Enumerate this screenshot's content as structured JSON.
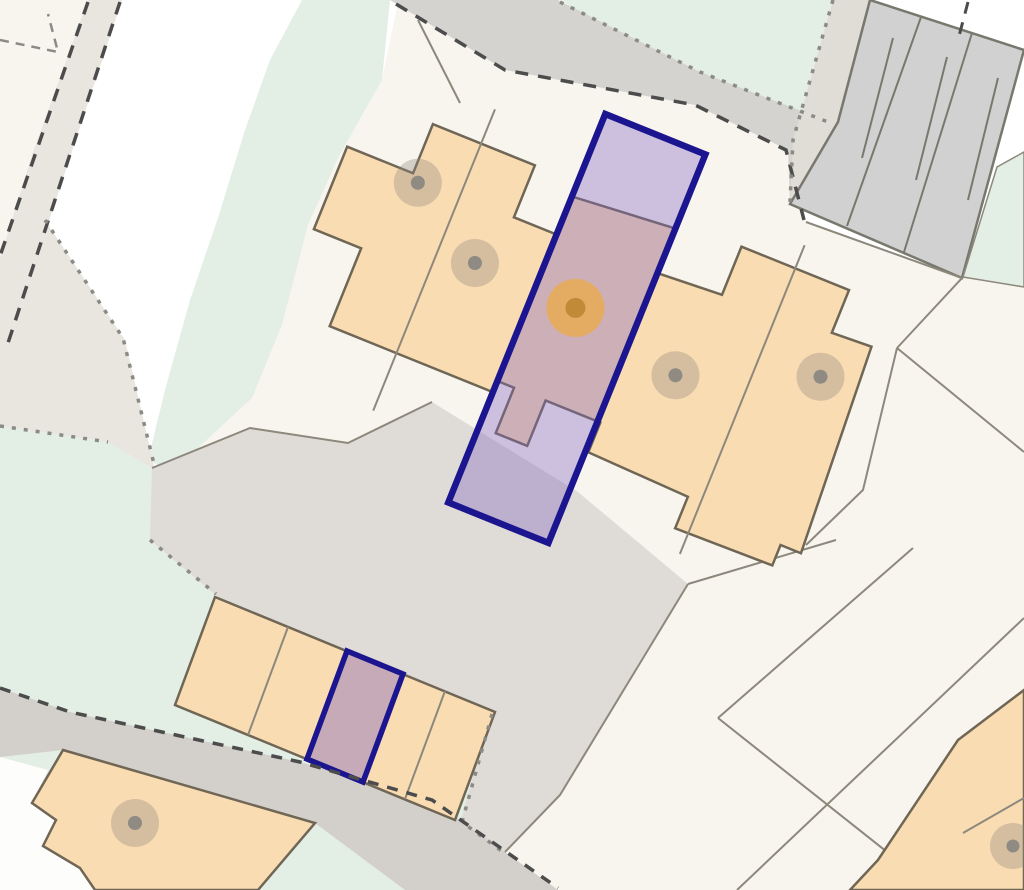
{
  "map": {
    "title": "property-plot-map",
    "canvas": {
      "width": 1024,
      "height": 890,
      "background": "#ffffff"
    },
    "palette": {
      "bg": "#ffffff",
      "parcelLight": "#f8f5ef",
      "verge": "#e9e5df",
      "green": "#e3eee5",
      "roadTop": "#d4d3d0",
      "bandCenter": "#dfdbd6",
      "roadBottom": "#d3d0cb",
      "margin": "#e0ddd6",
      "block": "#d1d1d1",
      "blockLine": "#78786f",
      "orange": "#f9dcb2",
      "outline": "#6f6655",
      "thin": "#8d887c",
      "dashDark": "#4c4c4c",
      "dot": "#8b8b86",
      "navy": "#1c1590",
      "purple": "rgba(128,100,190,0.36)",
      "purpleStall": "rgba(128,100,190,0.42)",
      "white": "#fdfdfb",
      "grayMarkOuter": "rgba(143,134,122,0.35)",
      "grayMarkInner": "#8f8a82",
      "orangeMarkOuter": "rgba(232,170,85,0.85)",
      "orangeMarkInner": "#c08a38"
    },
    "legend": {
      "highlight_plot_border": "#1c1590",
      "highlight_plot_fill": "purple translucent",
      "building_fill": "#f9dcb2",
      "green_space_fill": "#e3eee5",
      "road_fill": "#d4d3d0",
      "property_marker": "orange dot",
      "building_marker": "gray dot"
    },
    "features": [
      {
        "name": "estate-parcels",
        "kind": "polygon",
        "fill": "parcelLight",
        "points": "398,2 505,70 695,105 788,150 806,222 962,278 1024,205 1024,890 380,890 152,468 172,472 252,398 282,325 308,225 338,158 382,80"
      },
      {
        "name": "parcel-top-left",
        "kind": "polygon",
        "fill": "parcelLight",
        "points": "0,0 88,0 32,155 0,258"
      },
      {
        "name": "road-verge-left",
        "kind": "polygon",
        "fill": "verge",
        "points": "88,0 122,0 8,345 0,345 0,258 32,155"
      },
      {
        "name": "green-space-left",
        "kind": "polygon",
        "fill": "green",
        "points": "302,0 390,0 382,80 338,158 308,225 282,325 252,398 172,472 148,460 165,390 190,300 218,218 245,130 270,60"
      },
      {
        "name": "green-space-bottom",
        "kind": "polygon",
        "fill": "green",
        "points": "0,426 108,442 155,470 150,540 225,592 490,712 460,824 505,855 432,890 0,890"
      },
      {
        "name": "green-space-top-right",
        "kind": "polygon",
        "fill": "green",
        "points": "562,0 833,0 793,140 788,150 695,105"
      },
      {
        "name": "verge-wedge-center-left",
        "kind": "polygon",
        "fill": "verge",
        "points": "0,300 45,220 125,340 155,470 108,442 0,426"
      },
      {
        "name": "road-top",
        "kind": "polygon",
        "fill": "roadTop",
        "points": "390,0 505,70 695,105 788,150 790,204 830,122 700,72 558,0"
      },
      {
        "name": "garage-court-margin",
        "kind": "polygon",
        "fill": "margin",
        "points": "833,0 870,0 838,122 790,204 793,140"
      },
      {
        "name": "driveway-band-center",
        "kind": "polygon",
        "fill": "bandCenter",
        "points": "152,468 250,428 348,443 432,402 578,492 688,584 560,795 505,852 460,824 490,712 218,597 150,540"
      },
      {
        "name": "road-bottom",
        "kind": "polygon",
        "fill": "roadBottom",
        "points": "0,688 70,712 300,762 432,800 558,890 405,890 315,823 63,750 0,757"
      },
      {
        "name": "parcel-bottom-left-corner",
        "kind": "polygon",
        "fill": "white",
        "points": "0,757 48,770 32,803 56,820 43,846 80,868 95,890 0,890"
      },
      {
        "name": "building-bottom-left",
        "kind": "path",
        "fill": "orange",
        "stroke": "outline",
        "sw": 2.5,
        "d": "M63,750 L315,823 L258,890 L95,890 L80,868 L43,846 L56,820 L32,803 Z"
      },
      {
        "name": "building-marker-bottom-left-outer",
        "kind": "circle",
        "cx": 135,
        "cy": 823,
        "r": 24,
        "fill": "grayMarkOuter",
        "interactable": true
      },
      {
        "name": "building-marker-bottom-left-dot",
        "kind": "circle",
        "cx": 135,
        "cy": 823,
        "r": 7,
        "fill": "grayMarkInner"
      },
      {
        "name": "garage-block-top-right",
        "kind": "polygon",
        "fill": "block",
        "stroke": "blockLine",
        "sw": 2.5,
        "points": "870,0 1024,50 962,278 790,204 838,122"
      },
      {
        "name": "garage-block-divider-1",
        "kind": "line",
        "x1": 921,
        "y1": 17,
        "x2": 847,
        "y2": 226,
        "stroke": "blockLine",
        "sw": 2
      },
      {
        "name": "garage-block-divider-2",
        "kind": "line",
        "x1": 972,
        "y1": 33,
        "x2": 904,
        "y2": 252,
        "stroke": "blockLine",
        "sw": 2
      },
      {
        "name": "garage-block-stub-1",
        "kind": "line",
        "x1": 893,
        "y1": 38,
        "x2": 862,
        "y2": 158,
        "stroke": "blockLine",
        "sw": 2
      },
      {
        "name": "garage-block-stub-2",
        "kind": "line",
        "x1": 947,
        "y1": 57,
        "x2": 916,
        "y2": 180,
        "stroke": "blockLine",
        "sw": 2
      },
      {
        "name": "garage-block-stub-3",
        "kind": "line",
        "x1": 998,
        "y1": 78,
        "x2": 968,
        "y2": 200,
        "stroke": "blockLine",
        "sw": 2
      },
      {
        "name": "green-parcel-right-of-garages",
        "kind": "polygon",
        "fill": "green",
        "stroke": "thin",
        "sw": 1.5,
        "points": "997,167 1024,152 1024,287 963,277"
      },
      {
        "name": "boundary-below-garage-block",
        "kind": "polyline",
        "stroke": "thin",
        "sw": 2,
        "points": "806,222 962,278 897,348"
      },
      {
        "name": "boundary-right-1",
        "kind": "polyline",
        "stroke": "thin",
        "sw": 2,
        "points": "897,348 1024,452"
      },
      {
        "name": "boundary-right-2",
        "kind": "polyline",
        "stroke": "thin",
        "sw": 2,
        "points": "897,348 863,490 806,545"
      },
      {
        "name": "boundary-right-3",
        "kind": "polyline",
        "stroke": "thin",
        "sw": 2,
        "points": "836,540 688,584"
      },
      {
        "name": "boundary-right-4",
        "kind": "polyline",
        "stroke": "thin",
        "sw": 2,
        "points": "913,548 718,718"
      },
      {
        "name": "boundary-right-5",
        "kind": "polyline",
        "stroke": "thin",
        "sw": 2,
        "points": "1024,618 737,890"
      },
      {
        "name": "boundary-right-6",
        "kind": "polyline",
        "stroke": "thin",
        "sw": 2,
        "points": "718,718 935,890"
      },
      {
        "name": "driveway-edge-right",
        "kind": "polyline",
        "stroke": "thin",
        "sw": 2,
        "points": "688,584 560,795 505,852"
      },
      {
        "name": "driveway-edge-top",
        "kind": "polyline",
        "stroke": "thin",
        "sw": 2,
        "points": "152,468 250,428 348,443 432,402"
      },
      {
        "name": "parcel-line-top",
        "kind": "polyline",
        "stroke": "thin",
        "sw": 2,
        "points": "418,20 460,103"
      },
      {
        "name": "building-bottom-right",
        "kind": "path",
        "fill": "orange",
        "stroke": "outline",
        "sw": 2.5,
        "d": "M1024,690 L958,740 L878,860 L850,890 L1024,890 Z"
      },
      {
        "name": "building-bottom-right-divider",
        "kind": "line",
        "x1": 963,
        "y1": 833,
        "x2": 1024,
        "y2": 798,
        "stroke": "thin",
        "sw": 2
      },
      {
        "name": "building-marker-bottom-right-outer",
        "kind": "circle",
        "cx": 1013,
        "cy": 846,
        "r": 23,
        "fill": "grayMarkOuter",
        "interactable": true
      },
      {
        "name": "building-marker-bottom-right-dot",
        "kind": "circle",
        "cx": 1013,
        "cy": 846,
        "r": 6.5,
        "fill": "grayMarkInner"
      },
      {
        "name": "garage-row",
        "kind": "polygon",
        "fill": "orange",
        "stroke": "outline",
        "sw": 2.5,
        "points": "215,597 495,712 455,820 175,705"
      },
      {
        "name": "garage-row-divider-1",
        "kind": "line",
        "x1": 288,
        "y1": 627,
        "x2": 248,
        "y2": 735,
        "stroke": "thin",
        "sw": 2
      },
      {
        "name": "garage-row-divider-2",
        "kind": "line",
        "x1": 445,
        "y1": 691,
        "x2": 405,
        "y2": 799,
        "stroke": "thin",
        "sw": 2
      },
      {
        "name": "highlighted-garage-plot",
        "kind": "polygon",
        "fill": "purpleStall",
        "stroke": "navy",
        "sw": 5.5,
        "interactable": true,
        "points": "347,651 403,674 363,782 307,759"
      },
      {
        "name": "terrace-building",
        "kind": "path",
        "fill": "orange",
        "stroke": "outline",
        "sw": 2.5,
        "transform": "rotate(22 575 325)",
        "d": "M297,245 L368,245 L368,192 L478,192 L478,248 L524,248 L524,207 L632,198 L632,246 L700,242 L700,190 L816,190 L816,236 L858,234 L870,452 L848,452 L848,474 L744,476 L744,442 L635,438 L635,406 L576,406 L576,455 L542,455 L542,406 L524,406 L524,418 L348,418 L348,334 L297,334 Z"
      },
      {
        "name": "terrace-party-wall-1",
        "kind": "line",
        "x1": 420,
        "y1": 155,
        "x2": 420,
        "y2": 480,
        "stroke": "thin",
        "sw": 2,
        "transform": "rotate(22 575 325)"
      },
      {
        "name": "terrace-party-wall-2",
        "kind": "line",
        "x1": 758,
        "y1": 165,
        "x2": 758,
        "y2": 498,
        "stroke": "thin",
        "sw": 2,
        "transform": "rotate(22 575 325)"
      },
      {
        "name": "highlighted-property-plot",
        "kind": "rect",
        "x": 524,
        "y": 118,
        "w": 108,
        "h": 419,
        "fill": "purple",
        "stroke": "navy",
        "sw": 6.5,
        "transform": "rotate(22 575 325)",
        "interactable": true
      },
      {
        "name": "building-marker-1-outer",
        "kind": "circle",
        "cx": 376,
        "cy": 252,
        "r": 24,
        "fill": "grayMarkOuter",
        "transform": "rotate(22 575 325)",
        "interactable": true
      },
      {
        "name": "building-marker-1-dot",
        "kind": "circle",
        "cx": 376,
        "cy": 252,
        "r": 7,
        "fill": "grayMarkInner",
        "transform": "rotate(22 575 325)"
      },
      {
        "name": "building-marker-2-outer",
        "kind": "circle",
        "cx": 459,
        "cy": 305,
        "r": 24,
        "fill": "grayMarkOuter",
        "transform": "rotate(22 575 325)",
        "interactable": true
      },
      {
        "name": "building-marker-2-dot",
        "kind": "circle",
        "cx": 459,
        "cy": 305,
        "r": 7,
        "fill": "grayMarkInner",
        "transform": "rotate(22 575 325)"
      },
      {
        "name": "building-marker-3-outer",
        "kind": "circle",
        "cx": 687,
        "cy": 334,
        "r": 24,
        "fill": "grayMarkOuter",
        "transform": "rotate(22 575 325)",
        "interactable": true
      },
      {
        "name": "building-marker-3-dot",
        "kind": "circle",
        "cx": 687,
        "cy": 334,
        "r": 7,
        "fill": "grayMarkInner",
        "transform": "rotate(22 575 325)"
      },
      {
        "name": "building-marker-4-outer",
        "kind": "circle",
        "cx": 822,
        "cy": 281,
        "r": 24,
        "fill": "grayMarkOuter",
        "transform": "rotate(22 575 325)",
        "interactable": true
      },
      {
        "name": "building-marker-4-dot",
        "kind": "circle",
        "cx": 822,
        "cy": 281,
        "r": 7,
        "fill": "grayMarkInner",
        "transform": "rotate(22 575 325)"
      },
      {
        "name": "property-location-marker-outer",
        "kind": "circle",
        "cx": 569,
        "cy": 309,
        "r": 29,
        "fill": "orangeMarkOuter",
        "transform": "rotate(22 575 325)",
        "interactable": true
      },
      {
        "name": "property-location-marker-dot",
        "kind": "circle",
        "cx": 569,
        "cy": 309,
        "r": 10,
        "fill": "orangeMarkInner",
        "transform": "rotate(22 575 325)"
      },
      {
        "name": "boundary-dashed-topleft-1",
        "kind": "polyline",
        "stroke": "dashDark",
        "sw": 3.5,
        "dash": "13 10",
        "points": "88,2 0,256"
      },
      {
        "name": "boundary-dashed-topleft-2",
        "kind": "polyline",
        "stroke": "dashDark",
        "sw": 3.5,
        "dash": "13 10",
        "points": "120,2 8,343"
      },
      {
        "name": "parcel-dashed-inner",
        "kind": "polyline",
        "stroke": "dot",
        "sw": 2.5,
        "dash": "9 7",
        "points": "0,40 58,52 48,14"
      },
      {
        "name": "road-top-dashed-lower",
        "kind": "polyline",
        "stroke": "dashDark",
        "sw": 3.5,
        "dash": "13 10",
        "points": "396,4 505,70 695,105 786,150 804,220"
      },
      {
        "name": "road-top-dotted-upper",
        "kind": "polyline",
        "stroke": "dot",
        "sw": 3.5,
        "dash": "4 8",
        "points": "560,2 700,72 828,122"
      },
      {
        "name": "garage-court-dotted",
        "kind": "polyline",
        "stroke": "dot",
        "sw": 3.5,
        "dash": "4 8",
        "points": "833,0 793,140 790,202"
      },
      {
        "name": "corner-dash-top-right",
        "kind": "polyline",
        "stroke": "dashDark",
        "sw": 3,
        "dash": "12 9",
        "points": "968,2 958,40"
      },
      {
        "name": "verge-dotted-1",
        "kind": "polyline",
        "stroke": "dot",
        "sw": 3.5,
        "dash": "4 8",
        "points": "45,220 123,338 155,468"
      },
      {
        "name": "verge-dotted-2",
        "kind": "polyline",
        "stroke": "dot",
        "sw": 3.5,
        "dash": "4 8",
        "points": "0,426 108,442"
      },
      {
        "name": "driveway-dotted-1",
        "kind": "polyline",
        "stroke": "dot",
        "sw": 3.5,
        "dash": "4 8",
        "points": "150,540 216,594"
      },
      {
        "name": "driveway-dotted-2",
        "kind": "polyline",
        "stroke": "dot",
        "sw": 3.5,
        "dash": "4 8",
        "points": "492,714 462,822 503,852"
      },
      {
        "name": "road-bottom-dashed",
        "kind": "polyline",
        "stroke": "dashDark",
        "sw": 3.5,
        "dash": "11 9",
        "points": "0,688 70,712 300,762 432,800 558,888"
      }
    ]
  }
}
